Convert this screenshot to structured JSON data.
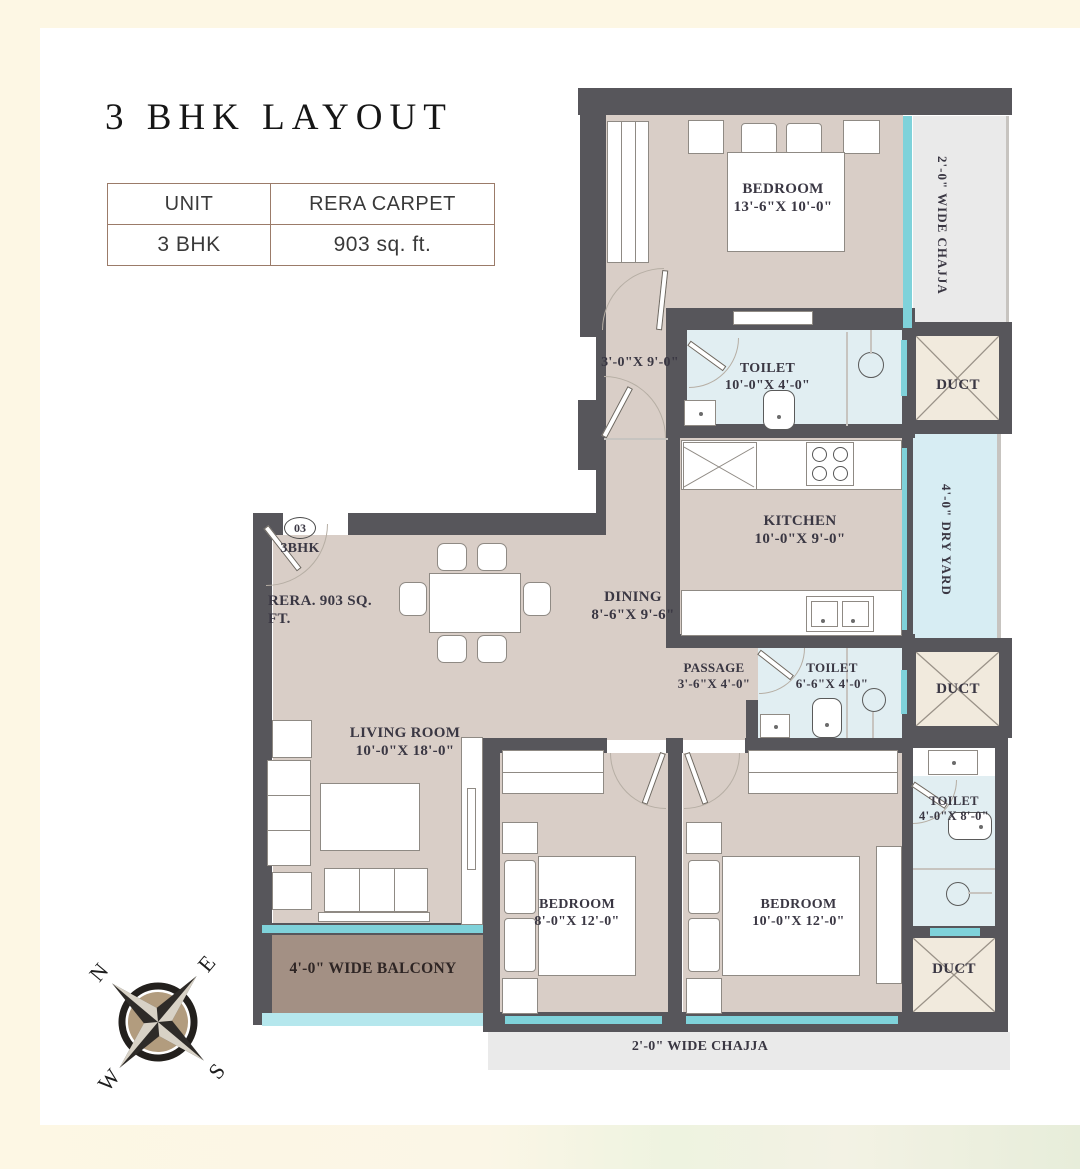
{
  "title": "3 BHK LAYOUT",
  "table": {
    "headers": [
      "UNIT",
      "RERA CARPET"
    ],
    "row": [
      "3 BHK",
      "903 sq. ft."
    ]
  },
  "rooms": {
    "bedroom_top": {
      "name": "BEDROOM",
      "dims": "13'-6\"X 10'-0\""
    },
    "passage_top_dims": "3'-0\"X 9'-0\"",
    "toilet1": {
      "name": "TOILET",
      "dims": "10'-0\"X 4'-0\""
    },
    "kitchen": {
      "name": "KITCHEN",
      "dims": "10'-0\"X 9'-0\""
    },
    "dining": {
      "name": "DINING",
      "dims": "8'-6\"X 9'-6\""
    },
    "passage": {
      "name": "PASSAGE",
      "dims": "3'-6\"X 4'-0\""
    },
    "toilet2": {
      "name": "TOILET",
      "dims": "6'-6\"X 4'-0\""
    },
    "living": {
      "name": "LIVING ROOM",
      "dims": "10'-0\"X 18'-0\""
    },
    "bedroom2": {
      "name": "BEDROOM",
      "dims": "8'-0\"X 12'-0\""
    },
    "bedroom3": {
      "name": "BEDROOM",
      "dims": "10'-0\"X 12'-0\""
    },
    "toilet3": {
      "name": "TOILET",
      "dims": "4'-0\"X 8'-0\""
    },
    "duct": "DUCT"
  },
  "zones": {
    "chajja_right": "2'-0\" WIDE CHAJJA",
    "dry_yard": "4'-0\" DRY YARD",
    "balcony": "4'-0\" WIDE BALCONY",
    "chajja_bottom": "2'-0\" WIDE CHAJJA"
  },
  "entry": {
    "number": "03",
    "type": "3BHK",
    "rera": "RERA. 903 SQ. FT."
  },
  "compass": {
    "n": "N",
    "e": "E",
    "s": "S",
    "w": "W"
  },
  "colors": {
    "wall": "#57565b",
    "floor": "#d9cec7",
    "toilet_floor": "#e1eef2",
    "window": "#7fd2da",
    "duct": "#f1eadd",
    "dry_yard": "#d7edf3",
    "chajja": "#eaeaea",
    "balcony": "#a39084",
    "table_border": "#9b7b69",
    "background_frame": "#fdf7e4"
  }
}
